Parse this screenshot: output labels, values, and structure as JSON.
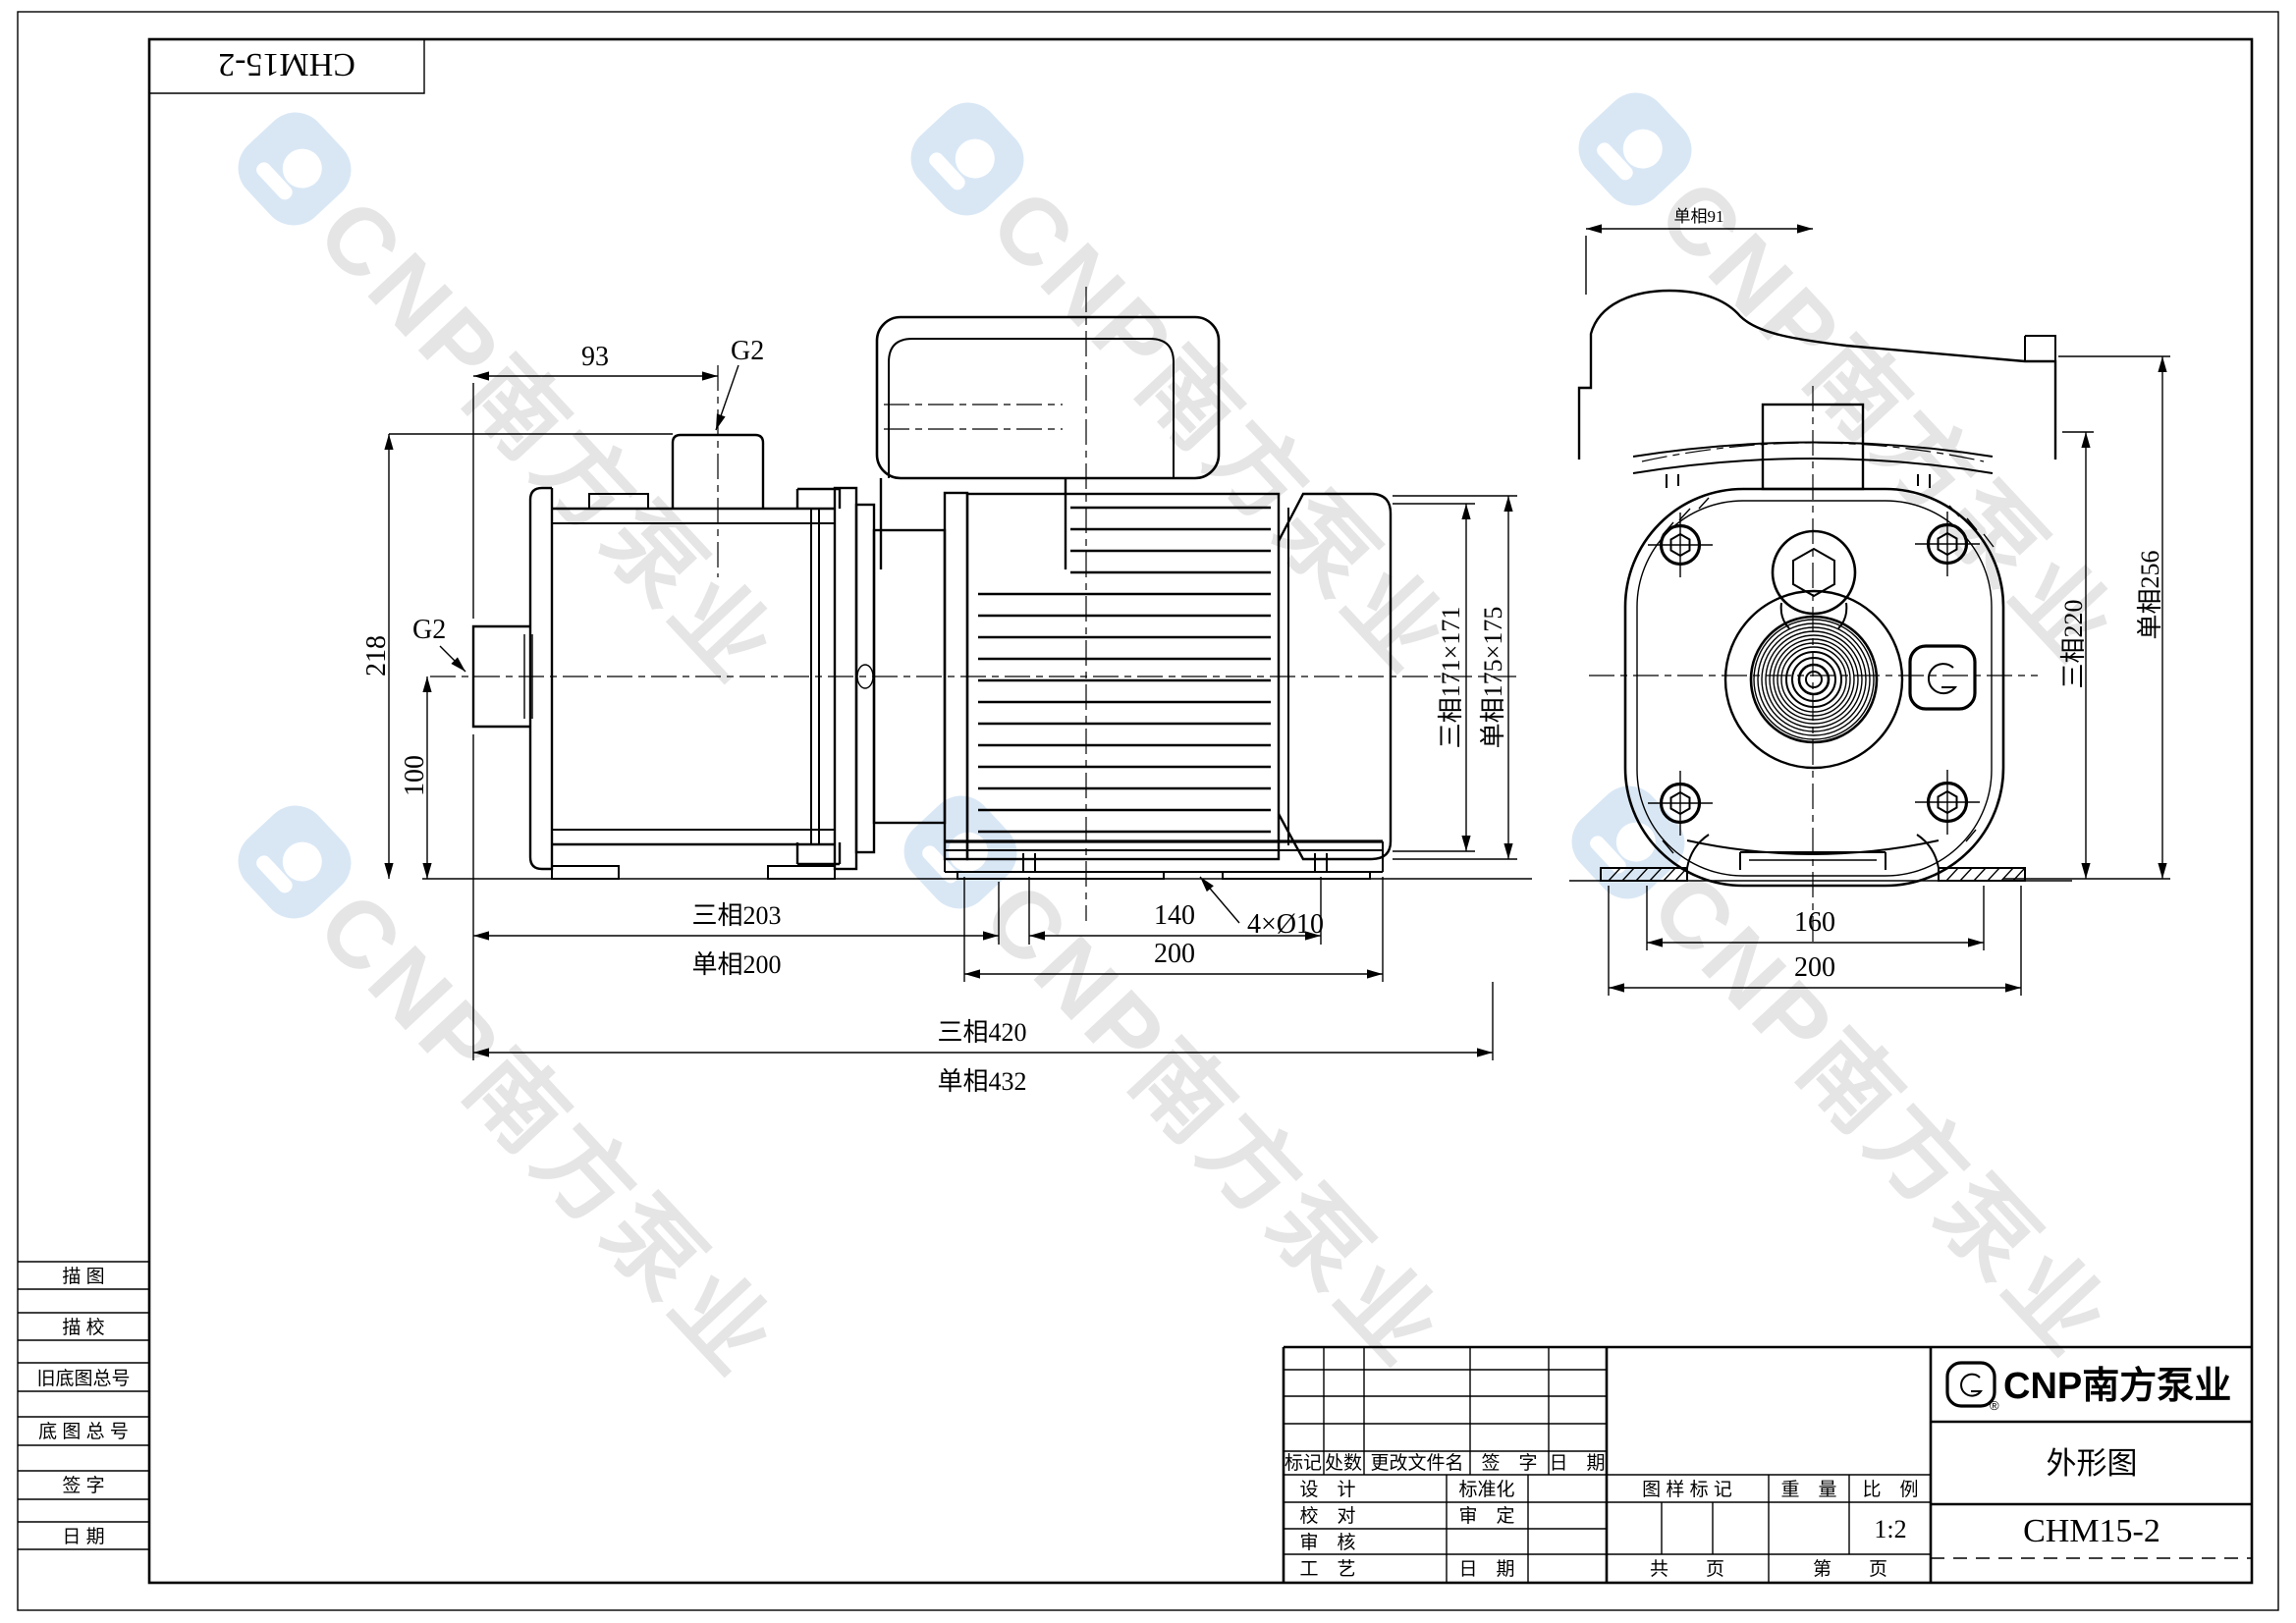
{
  "doc": {
    "model_top": "CHM15-2"
  },
  "watermark": {
    "brand": "CNP南方泵业"
  },
  "left_strip": {
    "rows": [
      "描  图",
      "描  校",
      "旧底图总号",
      "底 图 总 号",
      "签  字",
      "日  期"
    ]
  },
  "main_view": {
    "dims": {
      "w93": "93",
      "g2_top": "G2",
      "g2_left": "G2",
      "h218": "218",
      "h100": "100",
      "l3_203": "三相203",
      "l1_200": "单相200",
      "span140": "140",
      "base200": "200",
      "holes": "4×Ø10",
      "t3_420": "三相420",
      "t1_432": "单相432",
      "sq3_171": "三相171×171",
      "sq1_175": "单相175×175"
    }
  },
  "end_view": {
    "dims": {
      "w91": "单相91",
      "h3_220": "三相220",
      "h1_256": "单相256",
      "feet160": "160",
      "base200": "200"
    }
  },
  "title_block": {
    "rev_header": [
      "标记",
      "处数",
      "更改文件名",
      "签　字",
      "日　期"
    ],
    "sig": {
      "design": "设　计",
      "standard": "标准化",
      "proof": "校　对",
      "approve": "审　定",
      "review": "审　核",
      "craft": "工　艺",
      "date": "日　期"
    },
    "info": {
      "drawing_mark": "图 样 标 记",
      "weight": "重　量",
      "scale_label": "比　例",
      "scale": "1:2",
      "total_pages": "共　　页",
      "page_no": "第　　页"
    },
    "brand": {
      "name": "CNP南方泵业",
      "reg": "®",
      "title": "外形图",
      "model": "CHM15-2"
    }
  }
}
